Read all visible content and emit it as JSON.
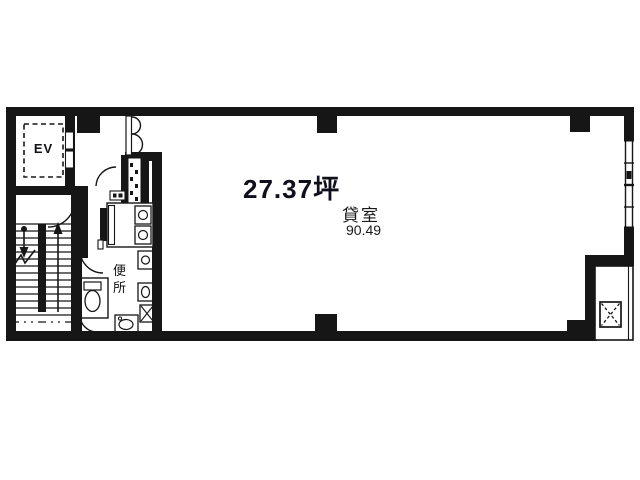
{
  "floorplan": {
    "unit_area_label": "27.37坪",
    "room": {
      "label": "貸室",
      "area_value": "90.49"
    },
    "elevator": {
      "label": "EV"
    },
    "toilet": {
      "label": "便所"
    },
    "colors": {
      "ink": "#161616",
      "paper": "#ffffff"
    }
  }
}
